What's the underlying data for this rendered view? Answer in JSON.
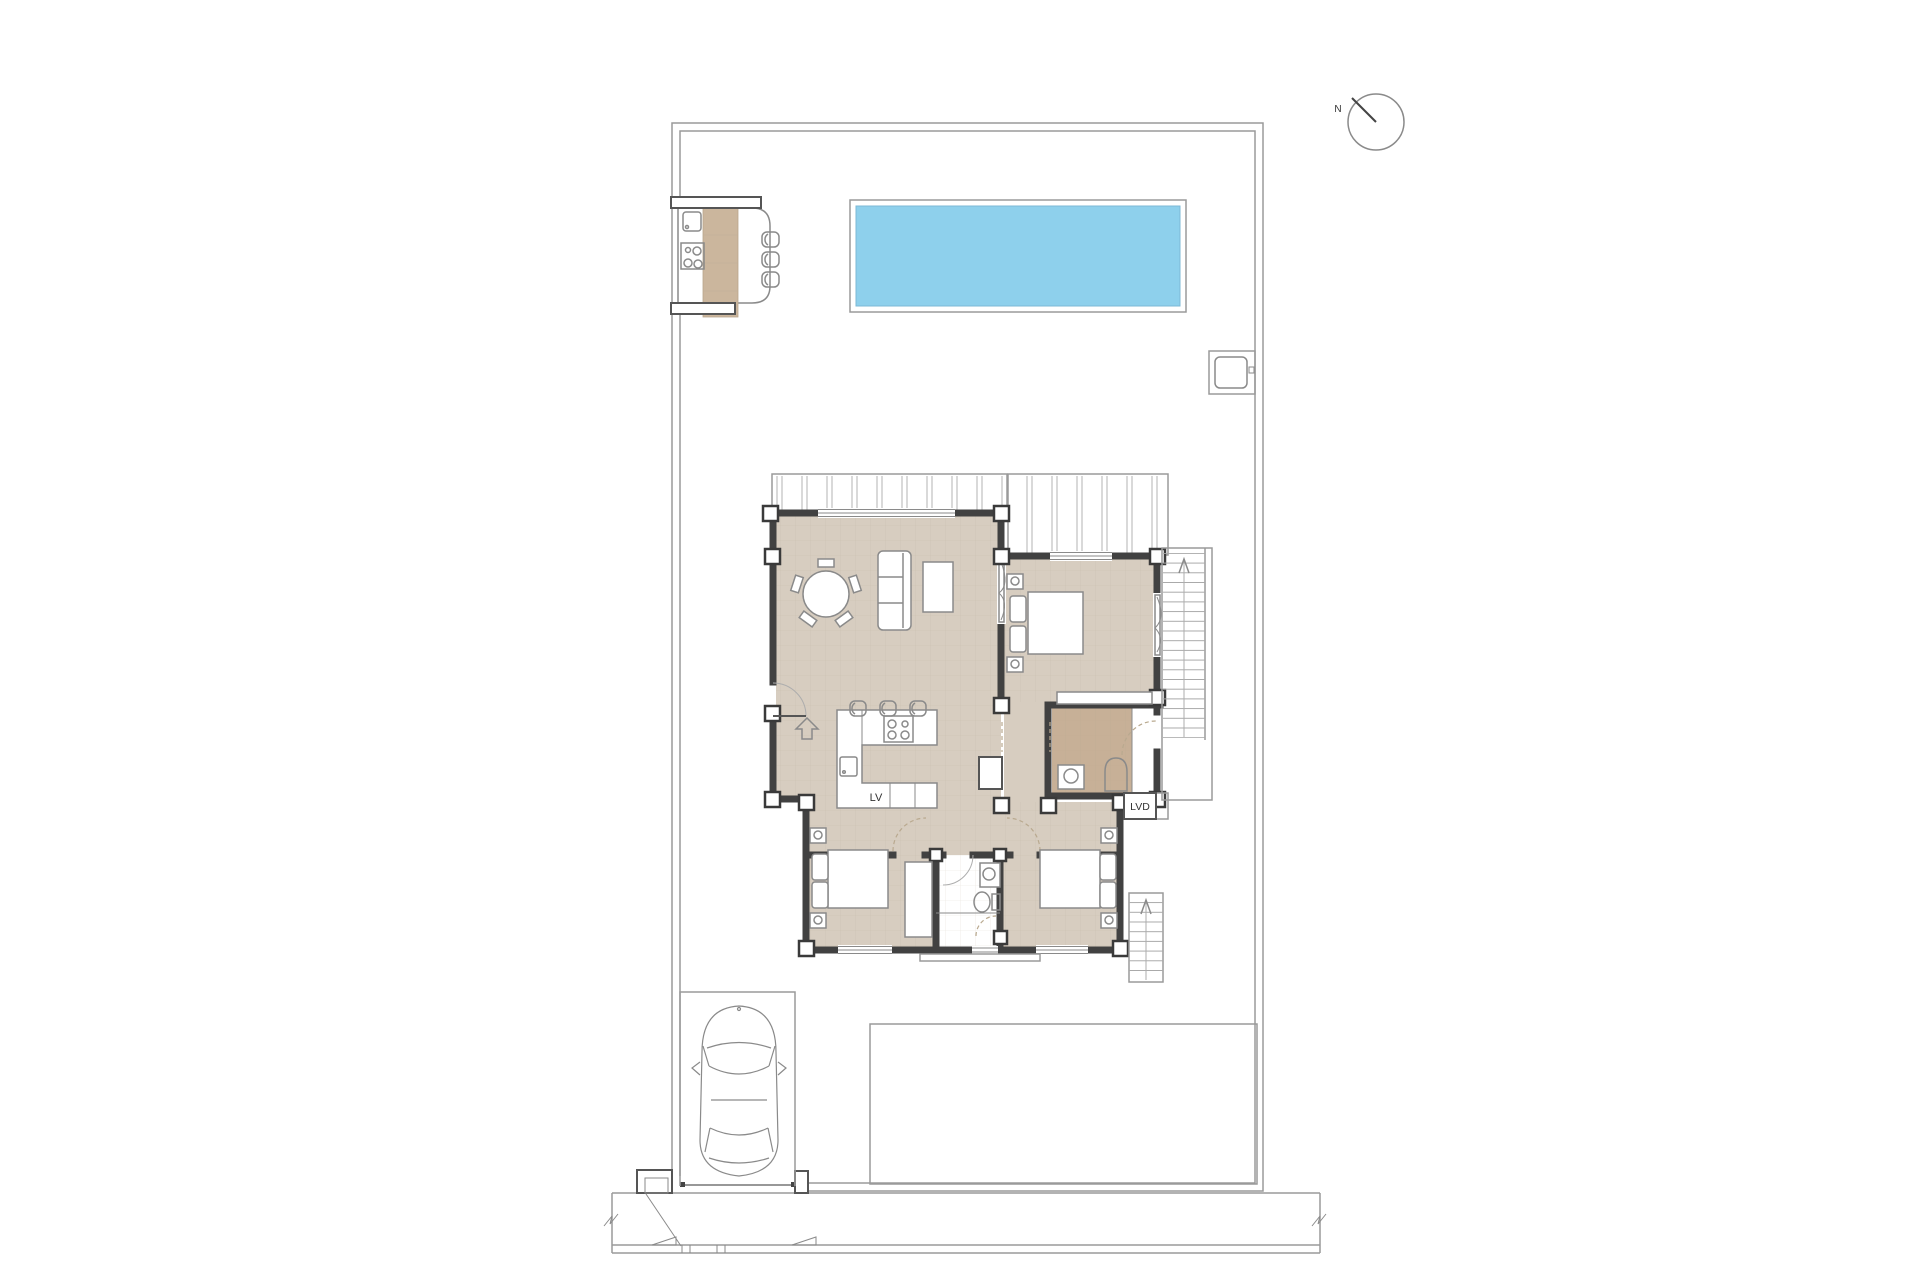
{
  "labels": {
    "north_indicator": "N",
    "dishwasher": "LV",
    "washing_machine": "LVD"
  },
  "colors": {
    "pool_water": "#8ed0ec",
    "pool_edge": "#7cb9d6",
    "interior_floor": "#d7cdc0",
    "bathroom_floor": "#c7b097",
    "outdoor_counter": "#cbb69d",
    "wall": "#414141"
  }
}
